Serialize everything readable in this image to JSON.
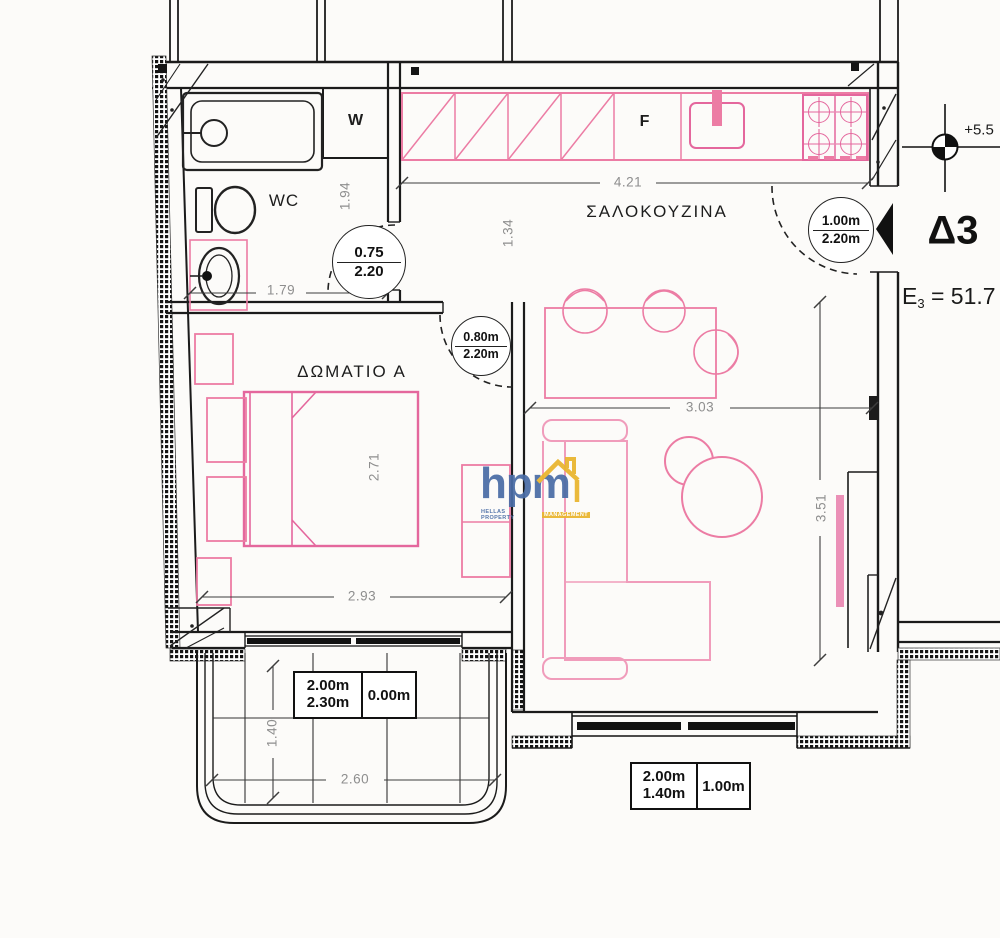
{
  "unit": {
    "id": "Δ3",
    "area_symbol": "E",
    "area_sub": "3",
    "area_value": "= 51.7",
    "elevation": "+5.5"
  },
  "rooms": {
    "living": "ΣΑΛΟΚΟΥΖΙΝΑ",
    "bedroom": "ΔΩΜΑΤΙΟ Α",
    "wc": "WC",
    "washer": "W",
    "fridge": "F"
  },
  "doors": {
    "wc": {
      "width": "0.75",
      "height": "2.20"
    },
    "bedroom": {
      "width": "0.80m",
      "height": "2.20m"
    },
    "entry": {
      "width": "1.00m",
      "height": "2.20m"
    }
  },
  "openings": {
    "bedroom_balcony": {
      "width": "2.00m",
      "height": "2.30m",
      "sill": "0.00m"
    },
    "living_window": {
      "width": "2.00m",
      "height": "1.40m",
      "sill": "1.00m"
    }
  },
  "dimensions": {
    "wc_width": "1.79",
    "wc_depth": "1.94",
    "hall": "1.34",
    "kitchen_run": "4.21",
    "bed_length": "2.71",
    "bedroom_width": "2.93",
    "living_width": "3.03",
    "living_depth": "3.51",
    "balcony_depth": "1.40",
    "balcony_width": "2.60"
  },
  "logo": {
    "name": "hpm",
    "tagline_left": "HELLAS PROPERTY",
    "tagline_right": "MANAGEMENT"
  },
  "colors": {
    "furniture_pink": "#ec7ca4",
    "bed_pink": "#e4679d",
    "wall_black": "#1b1b1b",
    "dim_gray": "#8e8e8e",
    "logo_blue": "#4a6da6",
    "logo_yellow": "#e9b52d"
  }
}
